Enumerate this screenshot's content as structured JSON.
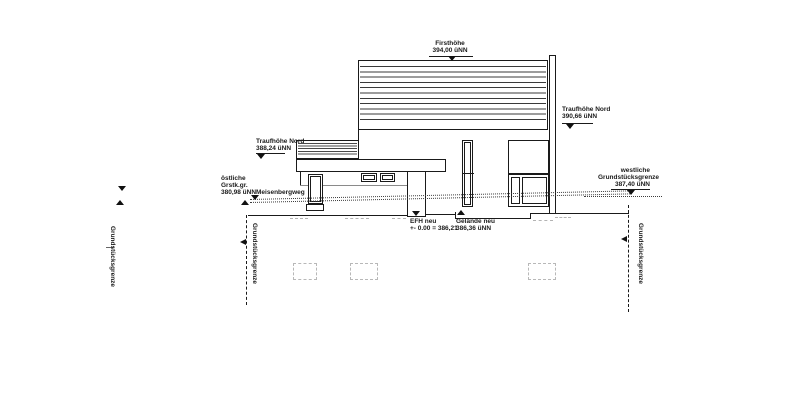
{
  "labels": {
    "firsthoehe": {
      "name": "Firsthöhe",
      "value": "394,00 üNN"
    },
    "traufhoehe_right": {
      "name": "Traufhöhe Nord",
      "value": "390,66 üNN"
    },
    "traufhoehe_left": {
      "name": "Traufhöhe Nord",
      "value": "388,24 üNN"
    },
    "east_boundary": {
      "line1": "östliche",
      "line2": "Grstk.gr.",
      "line3": "380,98 üNN"
    },
    "street": "Meisenbergweg",
    "west_boundary": {
      "line1": "westliche",
      "line2": "Grundstücksgrenze",
      "line3": "387,40 üNN"
    },
    "efh": {
      "line1": "EFH neu",
      "line2": "+- 0.00 = 386,21"
    },
    "gelaende": {
      "line1": "Gelände neu",
      "line2": "386,36 üNN"
    },
    "boundary_left_margin": "Grundstücksgrenze",
    "boundary_mid": "Grundstücksgrenze",
    "boundary_right": "Grundstücksgrenze"
  },
  "colors": {
    "line": "#1a1a1a",
    "faint_gray": "#b3b3b3",
    "background": "#ffffff"
  }
}
